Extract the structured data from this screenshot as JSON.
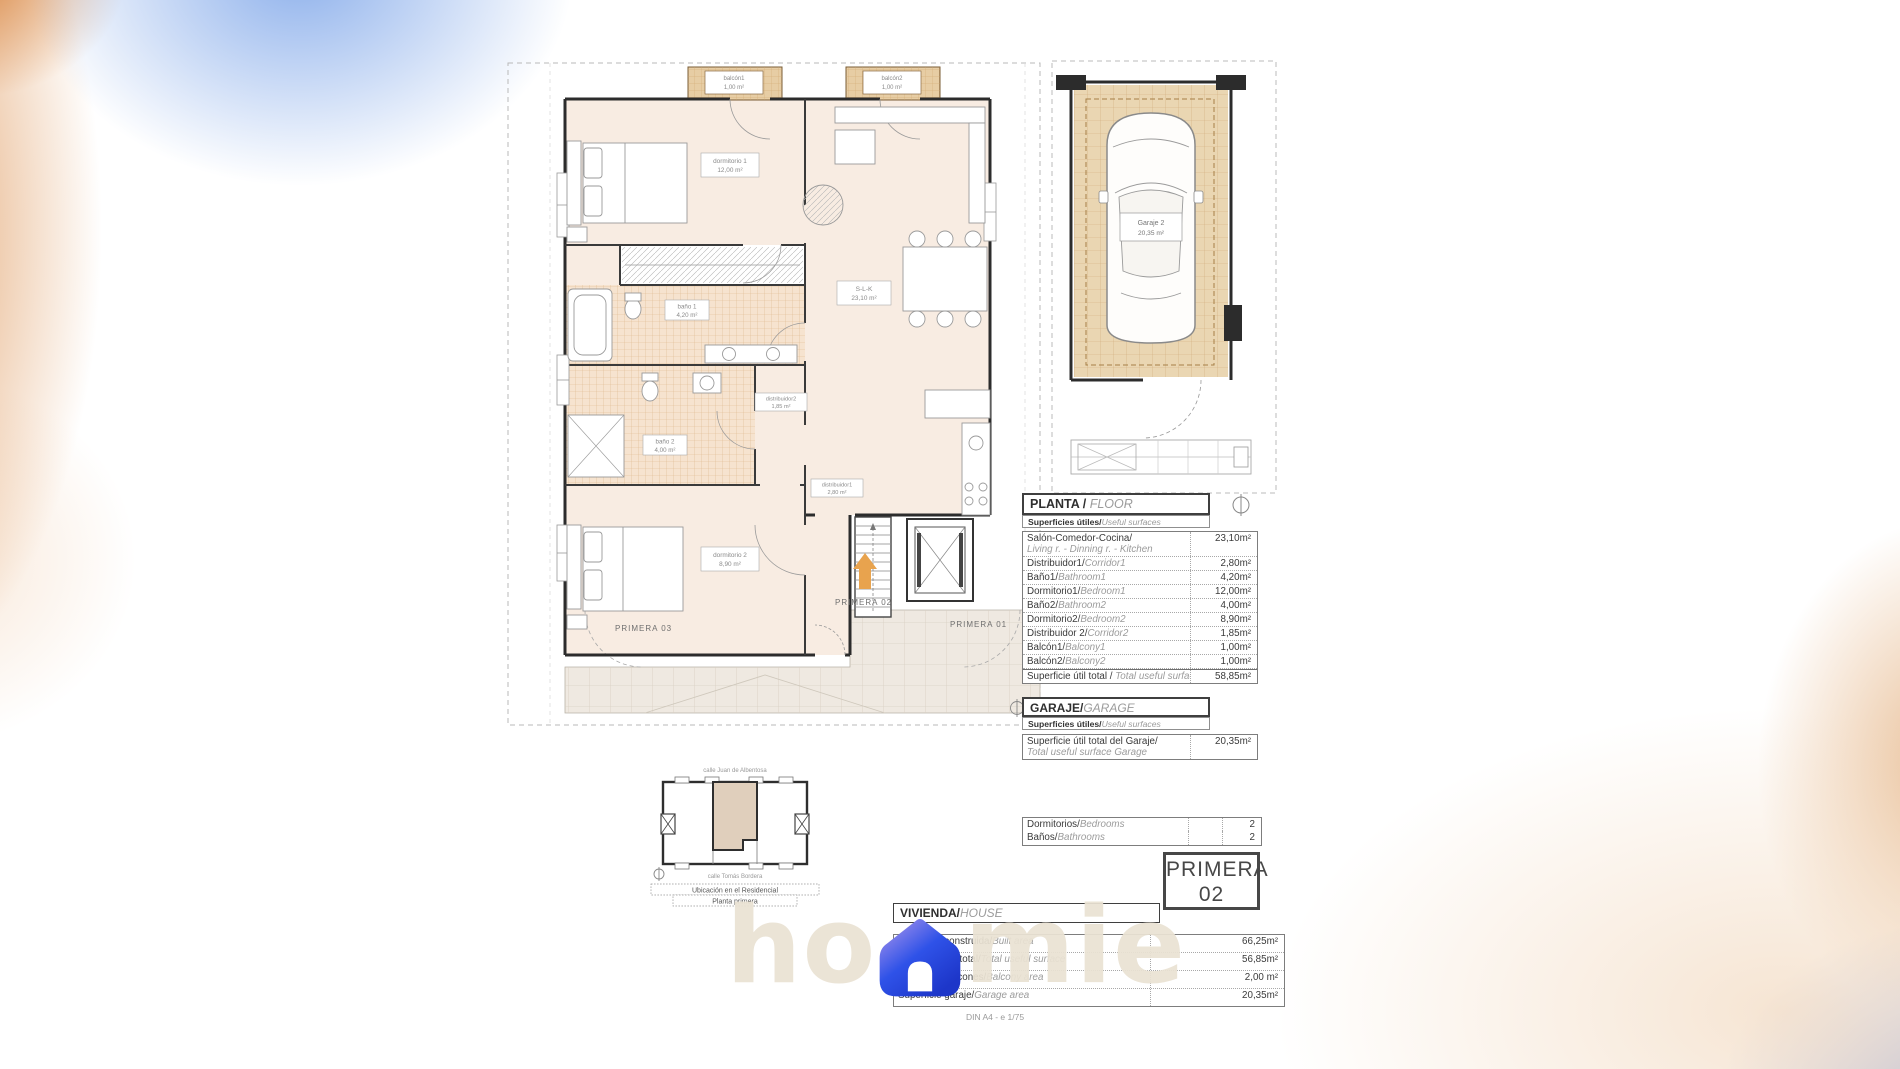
{
  "floor_plan": {
    "rooms": {
      "balcon1": {
        "name": "balcón1",
        "area": "1,00 m²"
      },
      "balcon2": {
        "name": "balcón2",
        "area": "1,00 m²"
      },
      "dormitorio1": {
        "name": "dormitorio 1",
        "area": "12,00 m²"
      },
      "bano1": {
        "name": "baño 1",
        "area": "4,20 m²"
      },
      "slk": {
        "name": "S-L-K",
        "area": "23,10 m²"
      },
      "bano2": {
        "name": "baño 2",
        "area": "4,00 m²"
      },
      "distribuidor2": {
        "name": "distribuidor2",
        "area": "1,85 m²"
      },
      "distribuidor1": {
        "name": "distribuidor1",
        "area": "2,80 m²"
      },
      "dormitorio2": {
        "name": "dormitorio 2",
        "area": "8,90 m²"
      }
    },
    "common_labels": {
      "left": "PRIMERA 03",
      "center": "PRIMERA 02",
      "right": "PRIMERA 01"
    }
  },
  "garage_plan": {
    "name": "Garaje 2",
    "area": "20,35 m²"
  },
  "planta_table": {
    "title_es": "PLANTA / ",
    "title_en": "FLOOR",
    "subtitle_es": "Superficies útiles/",
    "subtitle_en": "Useful surfaces",
    "rows": [
      {
        "es": "Salón-Comedor-Cocina/",
        "en": "Living r. - Dinning r. - Kitchen",
        "value": "23,10m²"
      },
      {
        "es": "Distribuidor1/",
        "en": "Corridor1",
        "value": "2,80m²"
      },
      {
        "es": "Baño1/",
        "en": "Bathroom1",
        "value": "4,20m²"
      },
      {
        "es": "Dormitorio1/",
        "en": "Bedroom1",
        "value": "12,00m²"
      },
      {
        "es": "Baño2/",
        "en": "Bathroom2",
        "value": "4,00m²"
      },
      {
        "es": "Dormitorio2/",
        "en": "Bedroom2",
        "value": "8,90m²"
      },
      {
        "es": "Distribuidor 2/",
        "en": "Corridor2",
        "value": "1,85m²"
      },
      {
        "es": "Balcón1/",
        "en": "Balcony1",
        "value": "1,00m²"
      },
      {
        "es": "Balcón2/",
        "en": "Balcony2",
        "value": "1,00m²"
      }
    ],
    "total": {
      "es": "Superficie útil total / ",
      "en": "Total useful surface",
      "value": "58,85m²"
    }
  },
  "garaje_table": {
    "title_es": "GARAJE/",
    "title_en": "GARAGE",
    "subtitle_es": "Superficies útiles/",
    "subtitle_en": "Useful surfaces",
    "row": {
      "es": "Superficie útil total del Garaje/",
      "en": "Total useful surface Garage",
      "value": "20,35m²"
    }
  },
  "counts": {
    "bedrooms": {
      "es": "Dormitorios/",
      "en": "Bedrooms",
      "value": "2"
    },
    "bathrooms": {
      "es": "Baños/",
      "en": "Bathrooms",
      "value": "2"
    }
  },
  "unit_badge": {
    "line1": "PRIMERA",
    "line2": "02"
  },
  "vivienda_table": {
    "title_es": "VIVIENDA/",
    "title_en": "HOUSE",
    "rows": [
      {
        "es": "Superficie construida/",
        "en": "Built area",
        "value": "66,25m²"
      },
      {
        "es": "Superficie útil total/",
        "en": "Total useful surface",
        "value": "56,85m²"
      },
      {
        "es": "Superficie balcones/",
        "en": "Balcony area",
        "value": "2,00 m²"
      },
      {
        "es": "Superficie garaje/",
        "en": "Garage area",
        "value": "20,35m²"
      }
    ]
  },
  "location_plan": {
    "street_top": "calle Juan de Albentosa",
    "street_bottom": "calle Tomás Bordera",
    "caption_line1": "Ubicación en el Residencial",
    "caption_line2": "Planta primera"
  },
  "footer": {
    "scale_note": "DIN A4 - e 1/75"
  },
  "watermark": {
    "text_left": "ho",
    "text_right": "mie"
  },
  "colors": {
    "accent_arrow": "#E8A34E",
    "logo_blue": "#2843DE",
    "logo_orange": "#EFA155",
    "watermark_beige": "#E9E2D3",
    "floor_peach": "#F8ECE2",
    "tile_tan": "#EAD6B2"
  }
}
